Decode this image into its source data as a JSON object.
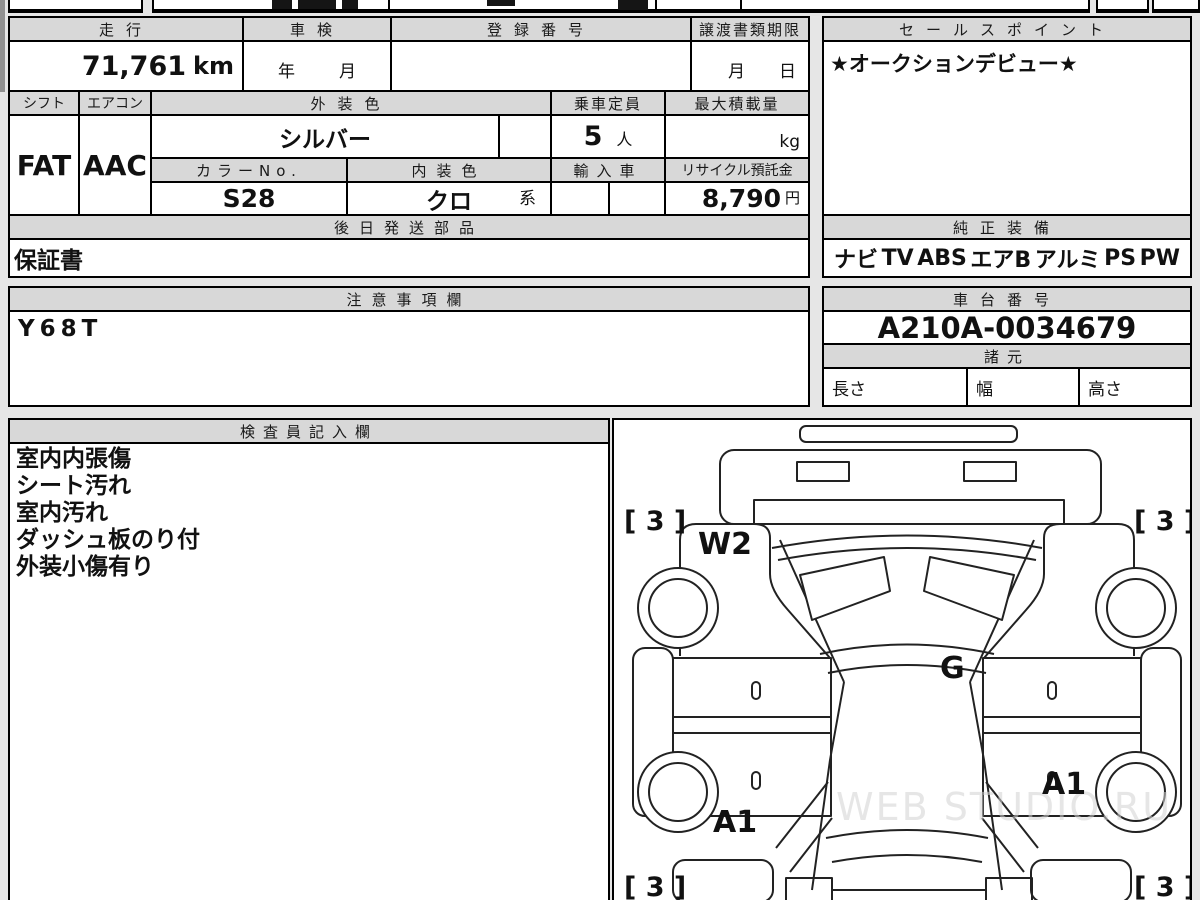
{
  "colors": {
    "sheet_bg": "#e6e6e6",
    "cell_bg": "#ffffff",
    "header_bg": "#d8d8d8",
    "line": "#000000",
    "ink": "#111111",
    "watermark": "#d3d3d3"
  },
  "table": {
    "mileage_label": "走行",
    "mileage_value": "71,761",
    "mileage_unit": "km",
    "shaken_label": "車検",
    "shaken_year_label": "年",
    "shaken_month_label": "月",
    "registration_label": "登録番号",
    "transfer_label": "譲渡書類期限",
    "transfer_month_label": "月",
    "transfer_day_label": "日",
    "shift_label": "シフト",
    "shift_value": "FAT",
    "aircon_label": "エアコン",
    "aircon_value": "AAC",
    "exterior_color_label": "外装色",
    "exterior_color_value": "シルバー",
    "capacity_label": "乗車定員",
    "capacity_value": "5",
    "capacity_unit": "人",
    "payload_label": "最大積載量",
    "payload_unit": "kg",
    "color_no_label": "カラーNo.",
    "color_no_value": "S28",
    "interior_color_label": "内装色",
    "interior_color_value": "クロ",
    "interior_color_suffix": "系",
    "import_label": "輸入車",
    "recycle_label": "リサイクル預託金",
    "recycle_value": "8,790",
    "recycle_unit": "円",
    "later_parts_label": "後日発送部品",
    "later_parts_value": "保証書"
  },
  "sales_point": {
    "label": "セールスポイント",
    "value": "★オークションデビュー★"
  },
  "equipment": {
    "label": "純正装備",
    "items": [
      "ナビ",
      "TV",
      "ABS",
      "エアB",
      "アルミ",
      "PS",
      "PW"
    ]
  },
  "notes": {
    "label": "注意事項欄",
    "value": "Y68T"
  },
  "chassis": {
    "label": "車台番号",
    "value": "A210A-0034679"
  },
  "specs": {
    "label": "諸元",
    "length_label": "長さ",
    "width_label": "幅",
    "height_label": "高さ"
  },
  "inspector": {
    "label": "検査員記入欄",
    "lines": [
      "室内内張傷",
      "シート汚れ",
      "室内汚れ",
      "ダッシュ板のり付",
      "外装小傷有り"
    ]
  },
  "diagram": {
    "watermark": "WEB STUDIO.RU",
    "marks": [
      {
        "label": "[ 3 ]",
        "position": "front-left-corner"
      },
      {
        "label": "[ 3 ]",
        "position": "front-right-corner"
      },
      {
        "label": "W2",
        "position": "left-front-fender"
      },
      {
        "label": "G",
        "position": "hood-rear-center"
      },
      {
        "label": "A1",
        "position": "left-rear-wheel-arch"
      },
      {
        "label": "A1",
        "position": "right-rear-door"
      },
      {
        "label": "[ 3 ]",
        "position": "rear-left-corner"
      },
      {
        "label": "[ 3 ]",
        "position": "rear-right-corner"
      }
    ]
  }
}
